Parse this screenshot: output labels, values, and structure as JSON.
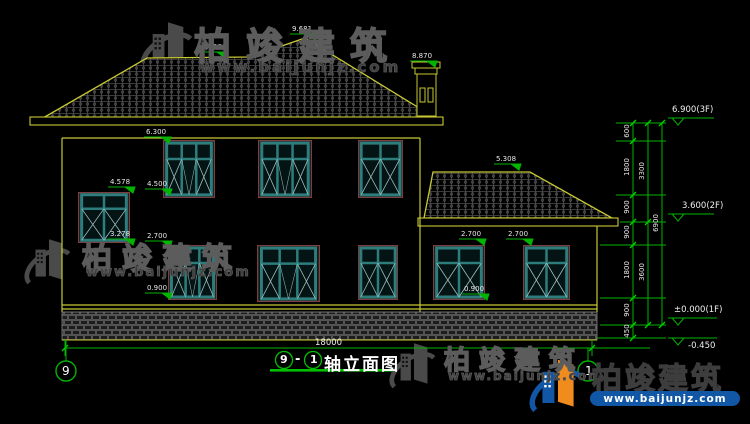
{
  "drawing": {
    "title": {
      "axis_a": "9",
      "sep": "-",
      "axis_b": "1",
      "name": "轴立面图"
    },
    "bottom_dim": "18000",
    "axis_left_bubble": "9",
    "axis_right_bubble": "1",
    "elevations": {
      "ridge_main": "9.681",
      "ridge_front": "9.219",
      "chimney_top": "8.870",
      "eave": "6.300",
      "wing_ridge": "5.308",
      "stair_win_top": "4.578",
      "sill_2f": "4.500",
      "stair_win_sill": "3.278",
      "win_top_1f_main": "2.700",
      "sill_1f_main": "0.900",
      "wing_win_top_a": "2.700",
      "wing_win_top_b": "2.700",
      "wing_sill": "0.900"
    },
    "levels": {
      "f3": "6.900(3F)",
      "f2": "3.600(2F)",
      "f1": "±0.000(1F)",
      "ground": "-0.450"
    },
    "chain": {
      "segments": [
        "600",
        "1800",
        "900",
        "900",
        "1800",
        "900",
        "450"
      ],
      "sub": [
        "3300",
        "3600"
      ],
      "total": "6900"
    }
  },
  "watermark": {
    "name": "柏竣建筑",
    "url": "www.baijunjz.com"
  },
  "colors": {
    "background": "#000000",
    "outline_yellow": "#c8c832",
    "dimension_green": "#00b400",
    "window_teal": "#2e7d7d",
    "sill_maroon": "#7a4040",
    "text_white": "#e8e8e8",
    "watermark_gray": "#4a4a4a",
    "logo_blue": "#1157a6",
    "logo_orange": "#f08c1e"
  }
}
